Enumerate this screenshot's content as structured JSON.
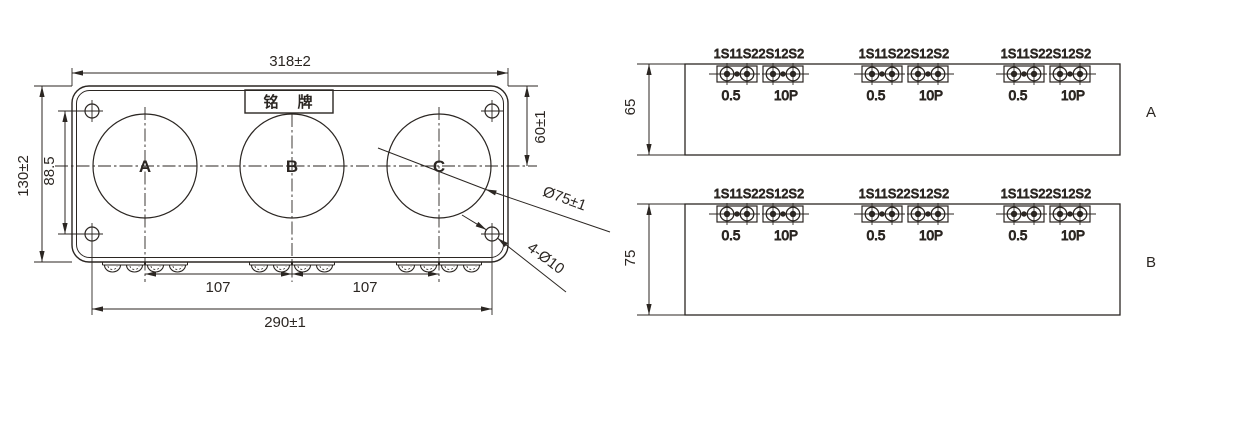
{
  "front_view": {
    "nameplate": "铭　牌",
    "window_labels": [
      "A",
      "B",
      "C"
    ],
    "dims": {
      "overall_width": "318±2",
      "overall_height": "130±2",
      "hole_pitch_vertical": "88.5",
      "top_to_window_center": "60±1",
      "window_diameter": "Ø75±1",
      "corner_holes": "4-Ø10",
      "window_pitch_left": "107",
      "window_pitch_right": "107",
      "hole_pitch_horizontal": "290±1"
    }
  },
  "side_views": [
    {
      "label": "A",
      "depth": "65"
    },
    {
      "label": "B",
      "depth": "75"
    }
  ],
  "terminals": {
    "top_label": "1S11S22S12S2",
    "left_class": "0.5",
    "right_class": "10P"
  },
  "colors": {
    "line": "#2b2622",
    "background": "#ffffff"
  }
}
